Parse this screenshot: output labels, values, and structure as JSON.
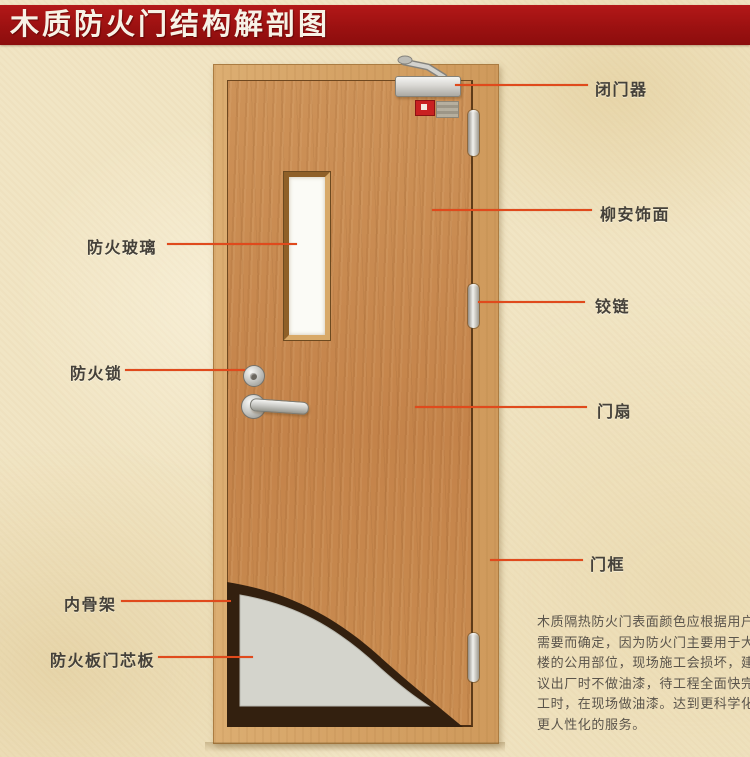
{
  "title": "木质防火门结构解剖图",
  "colors": {
    "banner_red": "#9c1111",
    "leader_line": "#e04a1c",
    "door_wood": "#c88d53",
    "frame_wood": "#d4a164",
    "core_gray": "#d4d4cc",
    "skeleton_dark": "#33200f",
    "background_parchment": "#f1e5c4"
  },
  "labels_left": [
    {
      "id": "fire-glass",
      "text": "防火玻璃"
    },
    {
      "id": "fire-lock",
      "text": "防火锁"
    },
    {
      "id": "inner-skeleton",
      "text": "内骨架"
    },
    {
      "id": "fire-board-core",
      "text": "防火板门芯板"
    }
  ],
  "labels_right": [
    {
      "id": "door-closer",
      "text": "闭门器"
    },
    {
      "id": "lauan-veneer",
      "text": "柳安饰面"
    },
    {
      "id": "hinge",
      "text": "铰链"
    },
    {
      "id": "door-leaf",
      "text": "门扇"
    },
    {
      "id": "door-frame",
      "text": "门框"
    }
  ],
  "description": {
    "lines": [
      "木质隔热防火门表面颜色应根据用户",
      "需要而确定，因为防火门主要用于大",
      "楼的公用部位，现场施工会损坏，建",
      "议出厂时不做油漆，待工程全面快完",
      "工时，在现场做油漆。达到更科学化",
      "更人性化的服务。"
    ]
  }
}
